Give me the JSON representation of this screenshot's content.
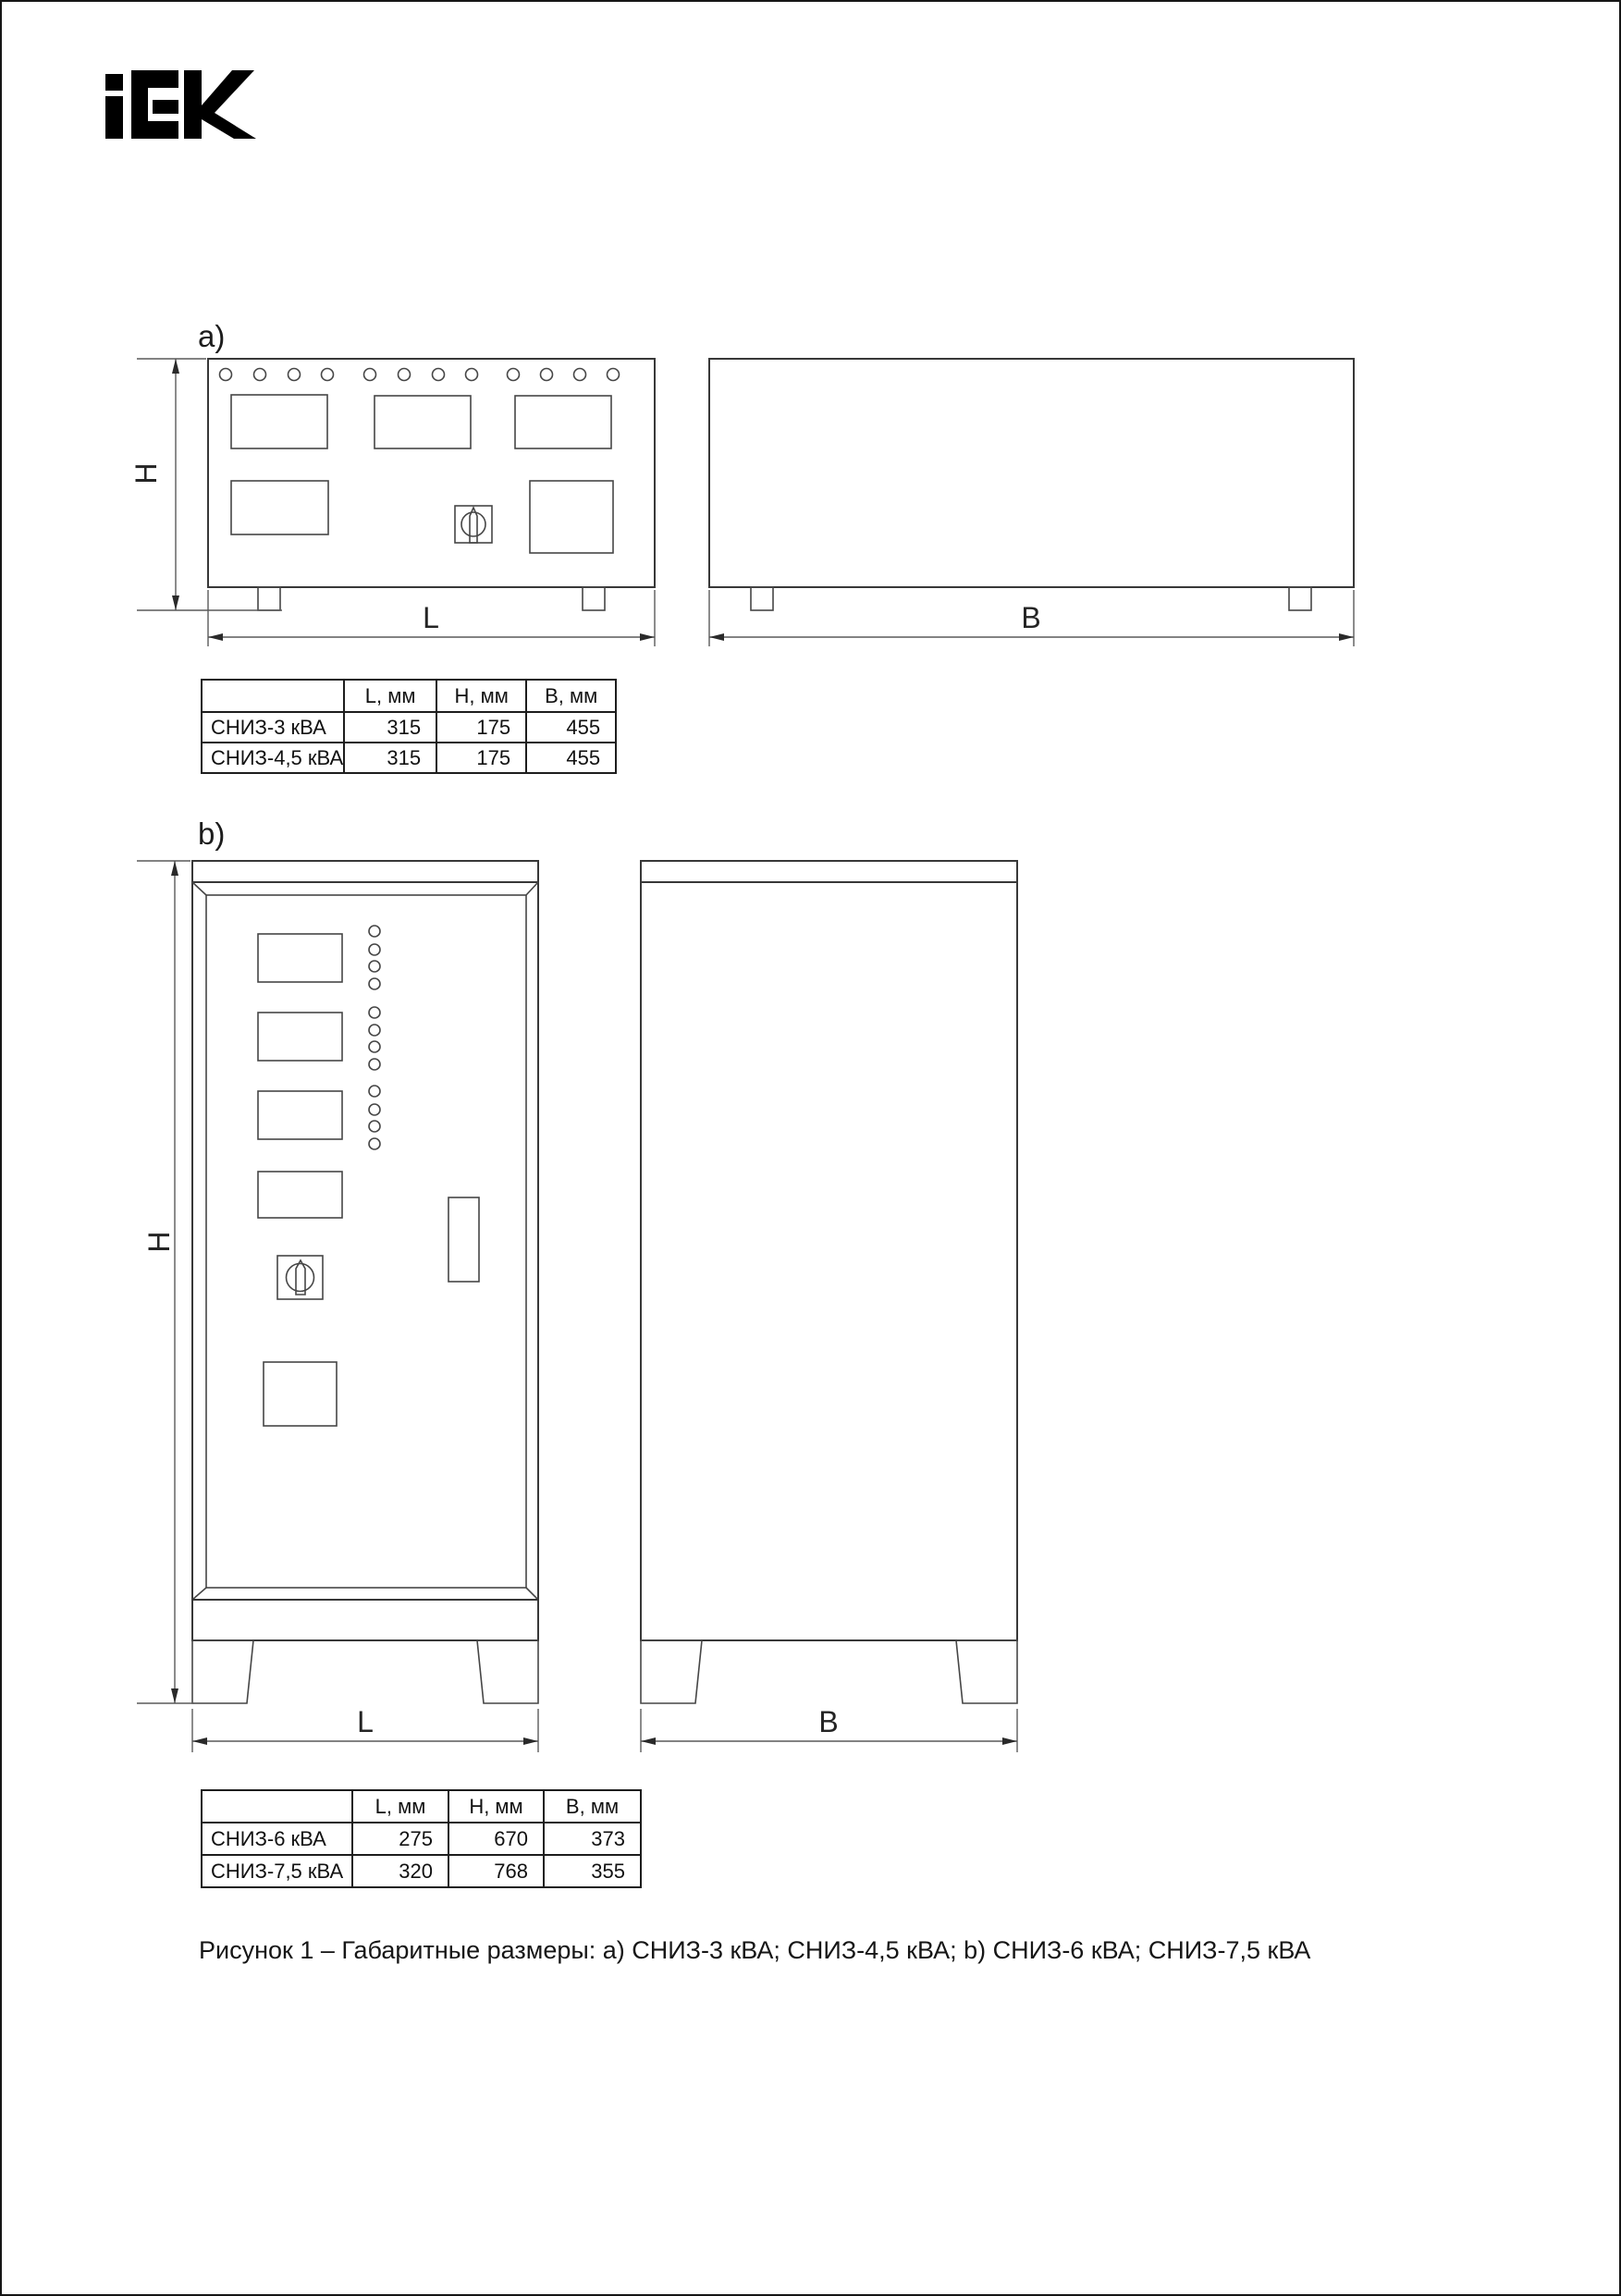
{
  "logo": {
    "name": "IEK",
    "color": "#000000"
  },
  "figure_a": {
    "label": "a)",
    "dim_h": "H",
    "dim_l": "L",
    "dim_b": "B",
    "table": {
      "headers": [
        "",
        "L, мм",
        "H, мм",
        "B, мм"
      ],
      "rows": [
        {
          "model": "СНИЗ-3 кВА",
          "l": "315",
          "h": "175",
          "b": "455"
        },
        {
          "model": "СНИЗ-4,5 кВА",
          "l": "315",
          "h": "175",
          "b": "455"
        }
      ]
    }
  },
  "figure_b": {
    "label": "b)",
    "dim_h": "H",
    "dim_l": "L",
    "dim_b": "B",
    "table": {
      "headers": [
        "",
        "L, мм",
        "H, мм",
        "B, мм"
      ],
      "rows": [
        {
          "model": "СНИЗ-6 кВА",
          "l": "275",
          "h": "670",
          "b": "373"
        },
        {
          "model": "СНИЗ-7,5 кВА",
          "l": "320",
          "h": "768",
          "b": "355"
        }
      ]
    }
  },
  "caption": "Рисунок 1 – Габаритные размеры: а) СНИЗ-3 кВА; СНИЗ-4,5 кВА; b) СНИЗ-6 кВА; СНИЗ-7,5 кВА"
}
